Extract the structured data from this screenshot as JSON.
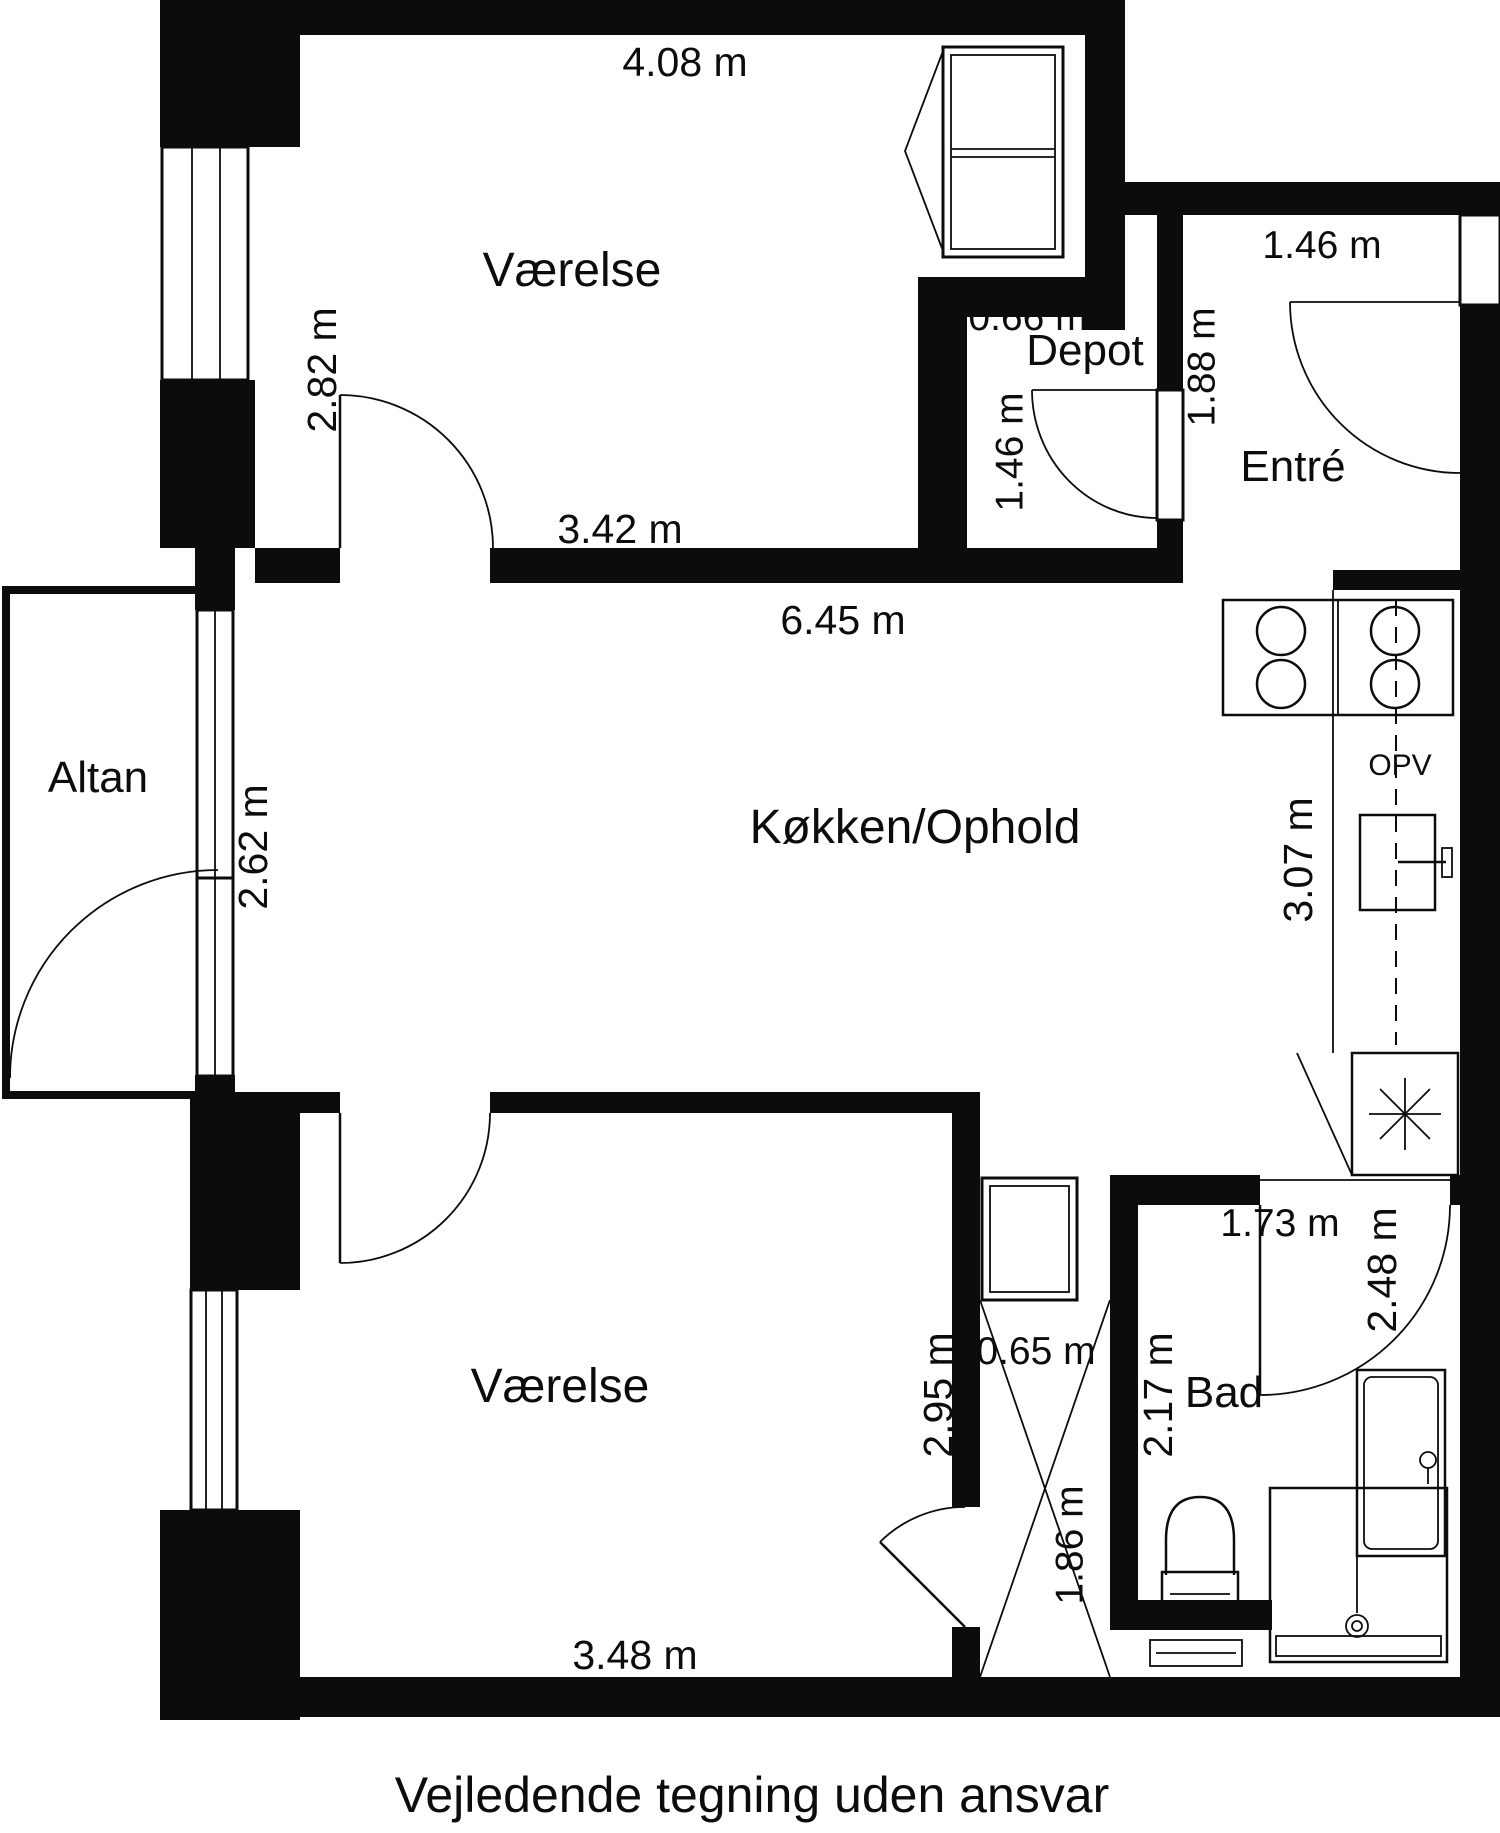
{
  "rooms": {
    "vaerelse_top": {
      "label": "Værelse",
      "width": "4.08 m",
      "height": "2.82 m",
      "inner_width": "3.42 m"
    },
    "depot": {
      "label": "Depot",
      "width": "0.66 m",
      "height": "1.46 m"
    },
    "entre": {
      "label": "Entré",
      "width": "1.46 m",
      "height": "1.88 m"
    },
    "kitchen": {
      "label": "Køkken/Ophold",
      "width": "6.45 m",
      "counter_height": "3.07 m",
      "appliance": "OPV"
    },
    "altan": {
      "label": "Altan",
      "door_height": "2.62 m"
    },
    "vaerelse_bottom": {
      "label": "Værelse",
      "width": "3.48 m",
      "height": "2.95 m"
    },
    "bad": {
      "label": "Bad",
      "width": "1.73 m",
      "height": "2.48 m",
      "inner_height": "2.17 m"
    },
    "shaft": {
      "width": "0.65 m",
      "height": "1.86 m"
    }
  },
  "footer": {
    "disclaimer": "Vejledende tegning uden ansvar"
  },
  "colors": {
    "wall": "#0c0c0c",
    "background": "#ffffff"
  }
}
